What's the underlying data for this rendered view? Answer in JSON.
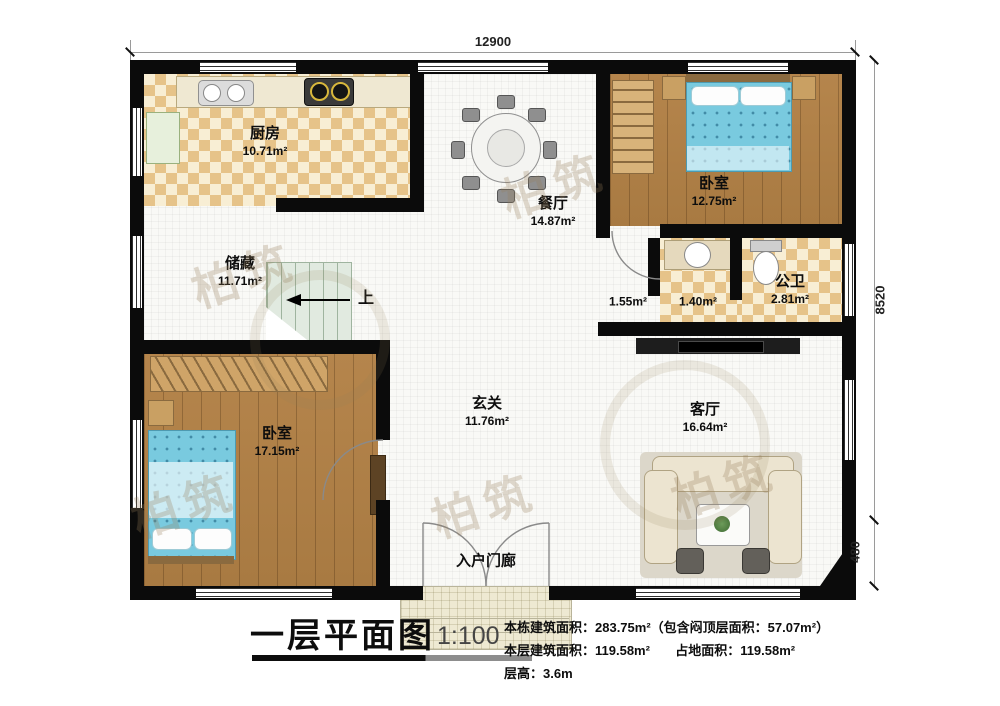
{
  "dimensions": {
    "top_width": "12900",
    "right_height": "8520",
    "right_step": "480"
  },
  "rooms": {
    "kitchen": {
      "name": "厨房",
      "area": "10.71m²"
    },
    "dining": {
      "name": "餐厅",
      "area": "14.87m²"
    },
    "bedroom_top": {
      "name": "卧室",
      "area": "12.75m²"
    },
    "bathroom": {
      "name": "公卫",
      "area": "2.81m²"
    },
    "corridor": {
      "area": "1.55m²"
    },
    "bath_vestibule": {
      "area": "1.40m²"
    },
    "storage": {
      "name": "储藏",
      "area": "11.71m²"
    },
    "bedroom_bottom": {
      "name": "卧室",
      "area": "17.15m²"
    },
    "foyer": {
      "name": "玄关",
      "area": "11.76m²"
    },
    "living": {
      "name": "客厅",
      "area": "16.64m²"
    },
    "porch": {
      "name": "入户门廊"
    }
  },
  "stairs": {
    "direction_label": "上"
  },
  "title_block": {
    "title": "一层平面图",
    "scale": "1:100",
    "building_area_line": "本栋建筑面积：283.75m²（包含闷顶层面积：57.07m²）",
    "floor_area": "本层建筑面积：119.58m²",
    "footprint_area": "占地面积：119.58m²",
    "floor_height": "层高：3.6m"
  },
  "watermark": {
    "text": "柏筑"
  },
  "colors": {
    "wall": "#0b0b0b",
    "tile_dark": "#e6c389",
    "tile_light": "#f8eed4",
    "wood": "#b0814a",
    "bed_blue": "#79cadf",
    "stair_green": "#e1eae0",
    "porch_tan": "#eee9d2"
  }
}
